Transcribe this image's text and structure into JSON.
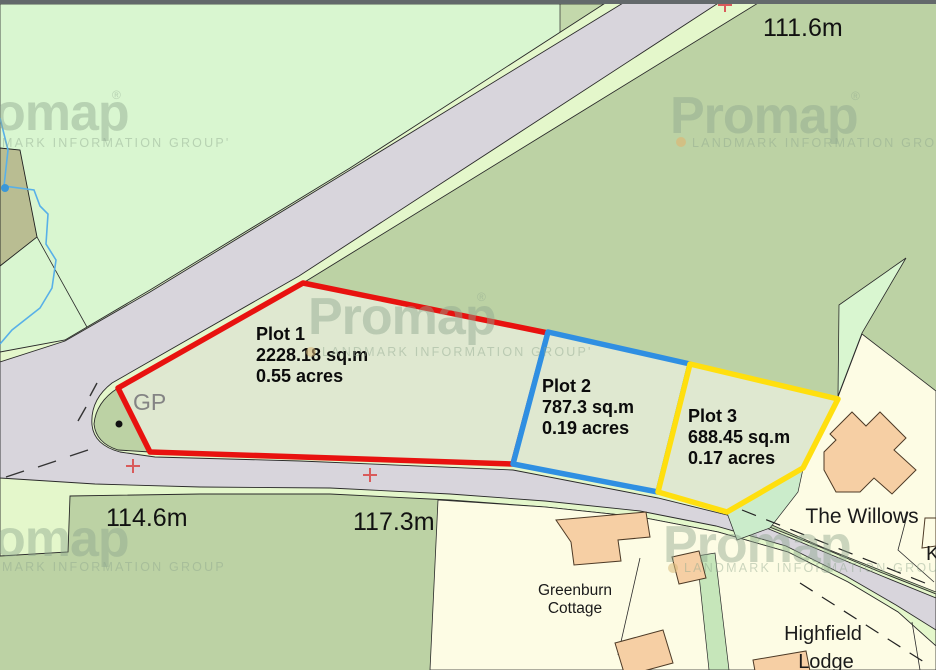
{
  "watermark": {
    "brand": "Promap",
    "brand_partial": "omap",
    "registered": "®",
    "group_line": "LANDMARK INFORMATION GROUP'",
    "group_line_plain": "LANDMARK INFORMATION GROUP",
    "group_partial": "MARK INFORMATION GROUP'",
    "group_partial_plain": "MARK INFORMATION GROUP"
  },
  "plots": [
    {
      "name": "Plot 1",
      "area": "2228.18 sq.m",
      "acres": "0.55 acres",
      "outline_color": "#e8120f"
    },
    {
      "name": "Plot 2",
      "area": "787.3 sq.m",
      "acres": "0.19 acres",
      "outline_color": "#2f8fe2"
    },
    {
      "name": "Plot 3",
      "area": "688.45 sq.m",
      "acres": "0.17 acres",
      "outline_color": "#ffdf0e"
    }
  ],
  "spot_heights": [
    {
      "label": "111.6m"
    },
    {
      "label": "114.6m"
    },
    {
      "label": "117.3m"
    }
  ],
  "features": {
    "gp_label": "GP",
    "the_willows": "The Willows",
    "greenburn_line1": "Greenburn",
    "greenburn_line2": "Cottage",
    "highfield_line1": "Highfield",
    "highfield_line2": "Lodge",
    "partial_label_right_edge": "K"
  },
  "colors": {
    "field_light": "#d9f6d0",
    "field_sage": "#bcd2a4",
    "rough_olive": "#b9bd92",
    "road_surface": "#d8d5dc",
    "road_verge": "#e4f7cb",
    "parcel_cream": "#fdfce4",
    "plot_fill": "#dfe8d0",
    "building_fill": "#f6cfa4",
    "mint_patch": "#cbeccb",
    "water_blue": "#58b0e8",
    "watermark_green": "#8da78d",
    "survey_cross_red": "#d95b5b",
    "top_edge_bar": "#63696b"
  }
}
